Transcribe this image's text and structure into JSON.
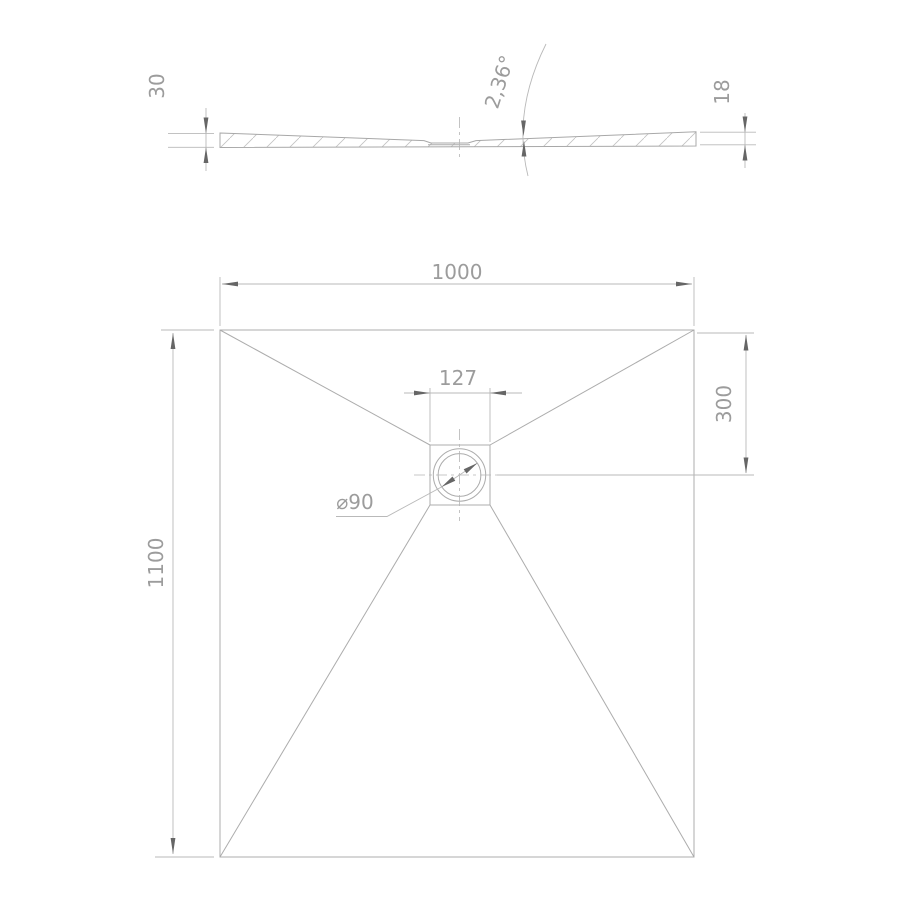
{
  "drawing": {
    "kind": "shower-tray technical drawing, section view and plan view",
    "colors": {
      "background": "#ffffff",
      "line": "#acacac",
      "dimension_line": "#b9b9b9",
      "text": "#9c9c9c",
      "arrow": "#666666"
    },
    "section_view": {
      "left_edge_height": "30",
      "right_edge_height": "18",
      "slope_angle": "2,36°"
    },
    "plan_view": {
      "width": "1000",
      "depth": "1100",
      "drain_offset_from_top": "300",
      "drain_plate_width": "127",
      "drain_diameter": "⌀90"
    }
  }
}
